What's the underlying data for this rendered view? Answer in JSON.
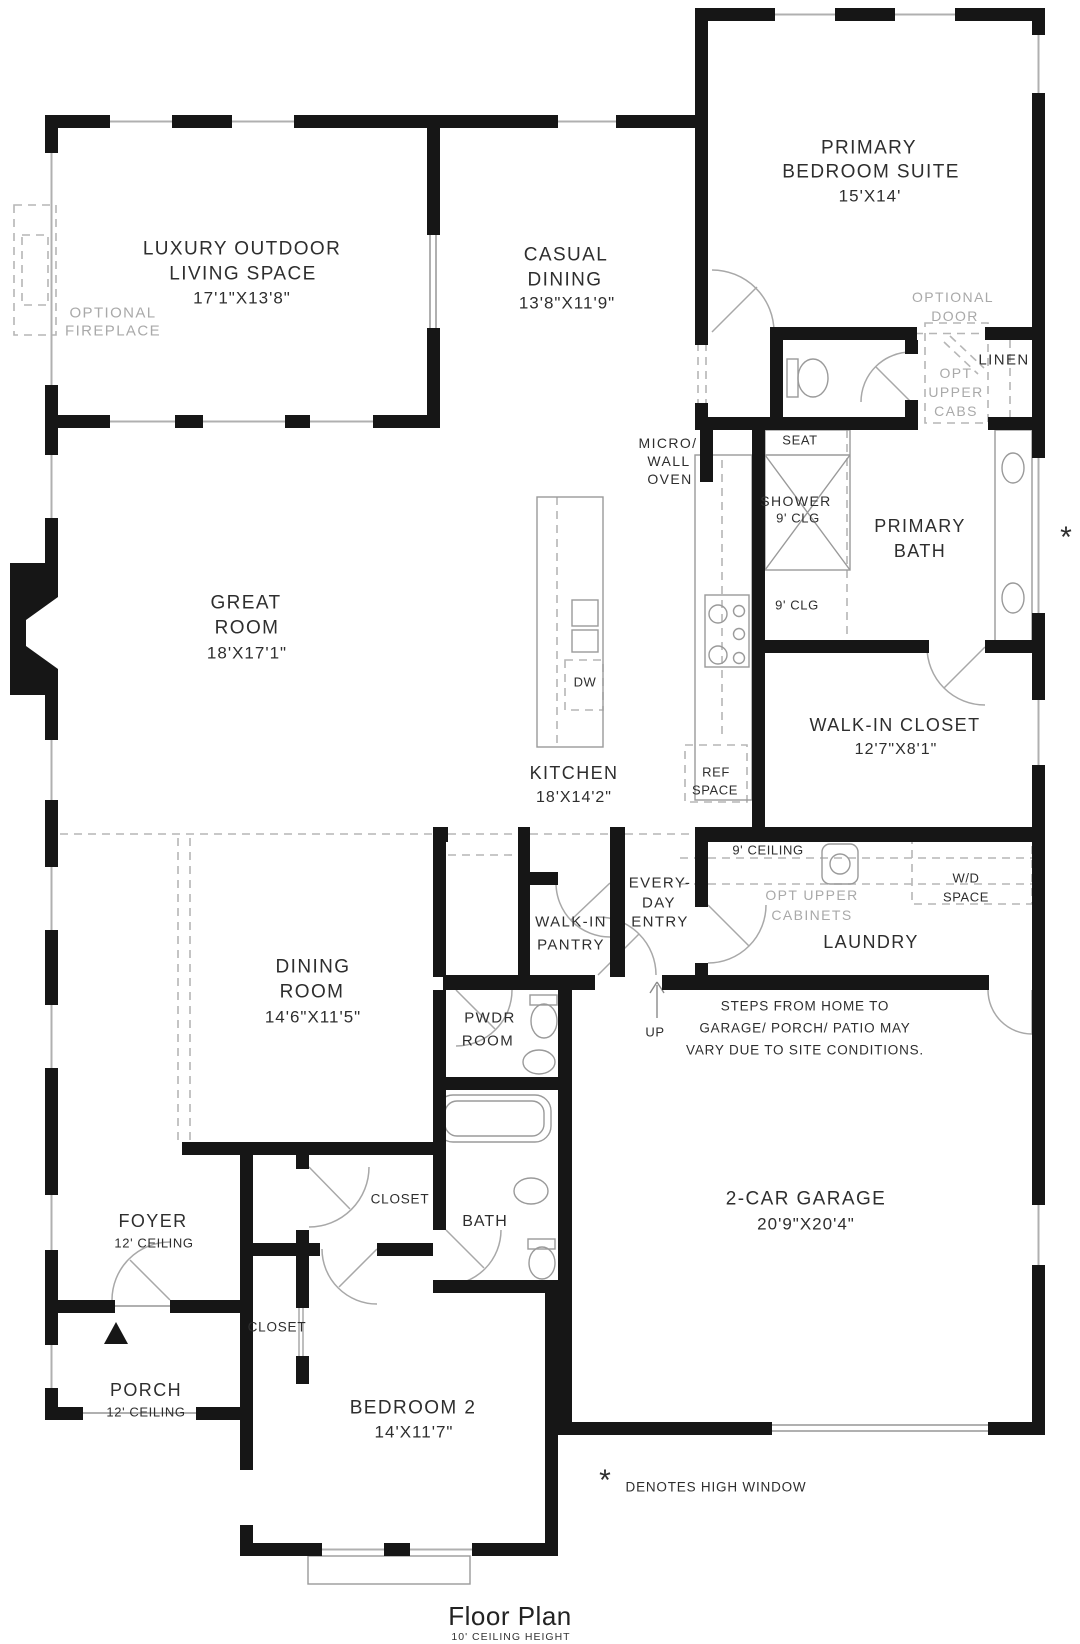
{
  "colors": {
    "wall": "#161616",
    "window_line": "#b0b0b0",
    "door_line": "#a8a8a8",
    "dashed_line": "#b6b6b6",
    "label_text": "#2e2e2e",
    "annotation_gray": "#a9a9a9",
    "background": "#ffffff"
  },
  "rooms": {
    "primary_suite": {
      "name1": "PRIMARY",
      "name2": "BEDROOM SUITE",
      "dims": "15'X14'"
    },
    "outdoor_living": {
      "name1": "LUXURY OUTDOOR",
      "name2": "LIVING SPACE",
      "dims": "17'1\"X13'8\""
    },
    "casual_dining": {
      "name1": "CASUAL",
      "name2": "DINING",
      "dims": "13'8\"X11'9\""
    },
    "great_room": {
      "name1": "GREAT",
      "name2": "ROOM",
      "dims": "18'X17'1\""
    },
    "kitchen": {
      "name1": "KITCHEN",
      "dims": "18'X14'2\""
    },
    "primary_bath": {
      "name1": "PRIMARY",
      "name2": "BATH"
    },
    "walk_in_closet": {
      "name1": "WALK-IN CLOSET",
      "dims": "12'7\"X8'1\""
    },
    "laundry": {
      "name1": "LAUNDRY"
    },
    "dining_room": {
      "name1": "DINING",
      "name2": "ROOM",
      "dims": "14'6\"X11'5\""
    },
    "pwdr_room": {
      "name1": "PWDR",
      "name2": "ROOM"
    },
    "everyday_entry": {
      "name1": "EVERY-",
      "name2": "DAY",
      "name3": "ENTRY"
    },
    "walk_in_pantry": {
      "name1": "WALK-IN",
      "name2": "PANTRY"
    },
    "garage": {
      "name1": "2-CAR GARAGE",
      "dims": "20'9\"X20'4\""
    },
    "foyer": {
      "name1": "FOYER",
      "ceiling": "12' CEILING"
    },
    "porch": {
      "name1": "PORCH",
      "ceiling": "12' CEILING"
    },
    "bedroom2": {
      "name1": "BEDROOM 2",
      "dims": "14'X11'7\""
    },
    "bath2": {
      "name1": "BATH"
    }
  },
  "annotations": {
    "optional_fireplace1": "OPTIONAL",
    "optional_fireplace2": "FIREPLACE",
    "optional_door1": "OPTIONAL",
    "optional_door2": "DOOR",
    "linen": "LINEN",
    "opt_upper_cabs1": "OPT",
    "opt_upper_cabs2": "UPPER",
    "opt_upper_cabs3": "CABS",
    "micro_wall_oven1": "MICRO/",
    "micro_wall_oven2": "WALL",
    "micro_wall_oven3": "OVEN",
    "seat": "SEAT",
    "shower1": "SHOWER",
    "shower2": "9' CLG",
    "clg_9": "9' CLG",
    "dw": "DW",
    "ref1": "REF",
    "ref2": "SPACE",
    "ceiling_9": "9' CEILING",
    "wd1": "W/D",
    "wd2": "SPACE",
    "opt_upper_cabinets1": "OPT UPPER",
    "opt_upper_cabinets2": "CABINETS",
    "up": "UP",
    "closet_hall": "CLOSET",
    "closet_bedroom2": "CLOSET"
  },
  "note": {
    "line1": "STEPS FROM HOME TO",
    "line2": "GARAGE/ PORCH/ PATIO MAY",
    "line3": "VARY DUE TO SITE CONDITIONS."
  },
  "legend": {
    "asterisk": "*",
    "high_window": "DENOTES HIGH WINDOW",
    "window_asterisk": "*"
  },
  "title": {
    "main": "Floor Plan",
    "sub": "10' CEILING HEIGHT"
  }
}
